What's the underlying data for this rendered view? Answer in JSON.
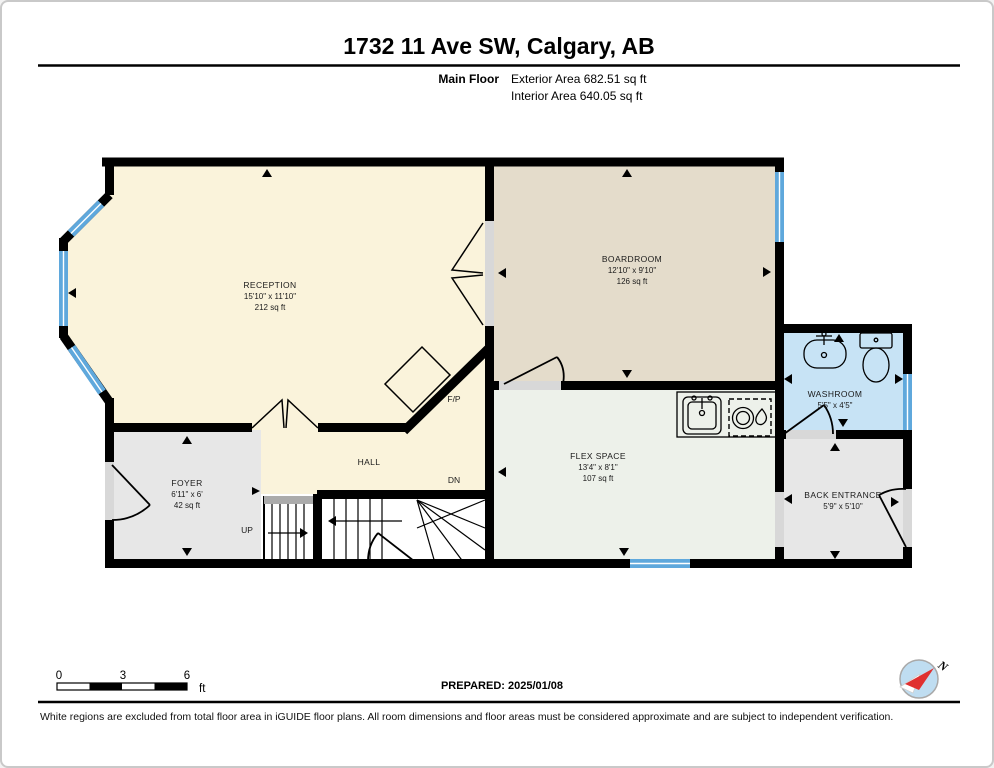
{
  "header": {
    "title": "1732 11 Ave SW, Calgary, AB",
    "floor_label": "Main Floor",
    "exterior_area": "Exterior Area 682.51 sq ft",
    "interior_area": "Interior Area 640.05 sq ft"
  },
  "rooms": {
    "reception": {
      "name": "RECEPTION",
      "dims": "15'10\" x 11'10\"",
      "area": "212 sq ft"
    },
    "boardroom": {
      "name": "BOARDROOM",
      "dims": "12'10\" x 9'10\"",
      "area": "126 sq ft"
    },
    "washroom": {
      "name": "WASHROOM",
      "dims": "5'5\" x 4'5\""
    },
    "flex_space": {
      "name": "FLEX SPACE",
      "dims": "13'4\" x 8'1\"",
      "area": "107 sq ft"
    },
    "foyer": {
      "name": "FOYER",
      "dims": "6'11\" x 6'",
      "area": "42 sq ft"
    },
    "hall": {
      "name": "HALL"
    },
    "back_entrance": {
      "name": "BACK ENTRANCE",
      "dims": "5'9\" x 5'10\""
    }
  },
  "annotations": {
    "fireplace": "F/P",
    "stairs_up": "UP",
    "stairs_down": "DN",
    "compass_north": "N"
  },
  "scale_bar": {
    "ticks": [
      "0",
      "3",
      "6"
    ],
    "unit": "ft"
  },
  "footer": {
    "prepared": "PREPARED: 2025/01/08",
    "disclaimer": "White regions are excluded from total floor area in iGUIDE floor plans. All room dimensions and floor areas must be considered approximate and are subject to independent verification."
  },
  "colors": {
    "reception": "#FAF3DB",
    "boardroom": "#E4DCCB",
    "washroom": "#C7E3F5",
    "flex": "#EDF1EA",
    "foyer": "#E7E7E7",
    "back_entrance": "#E7E7E7",
    "window": "#5FA8DC",
    "opening": "#D8D8D8",
    "landing": "#ABABAB",
    "compass_fill": "#BFDDF1",
    "compass_needle": "#E03030"
  }
}
